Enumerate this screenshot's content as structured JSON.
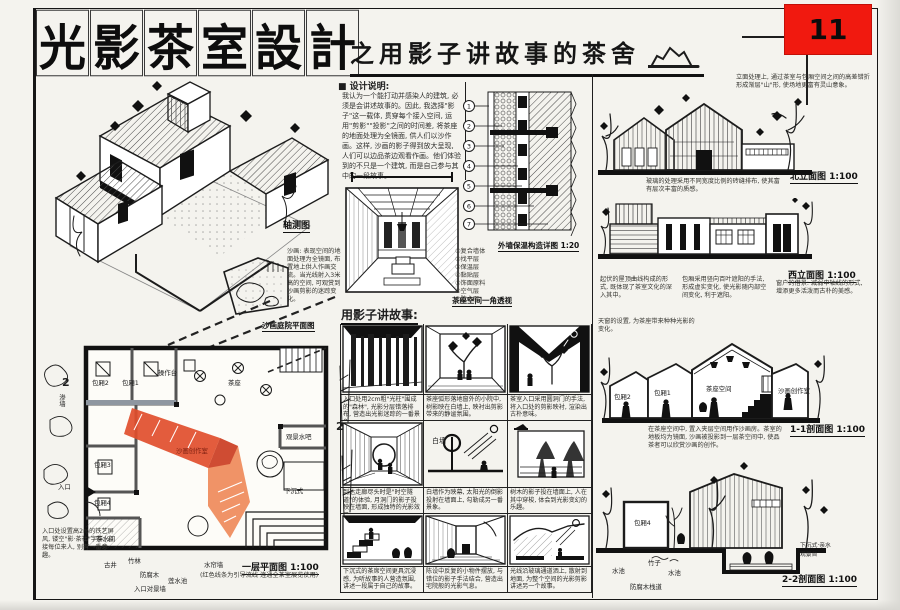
{
  "page": {
    "number": "11",
    "title_chars": [
      "光",
      "影",
      "茶",
      "室",
      "設",
      "計"
    ],
    "subtitle": "之用影子讲故事的茶舍"
  },
  "design_notes": {
    "header": "■ 设计说明:",
    "body": "我认为一个能打动并感染人的建筑, 必须是会讲述故事的。因此, 我选择\"影子\"这一载体, 贯穿每个接入空间, 运用\"剪影\"\"投影\"之间的时间差, 将茶座的地面处理为全镜面, 供人们以沙作画。这样, 沙画的影子得到放大呈现, 人们可以边品茶边观看作画。他们体验到的不只是一个建筑, 而是自己参与其中的一段故事。"
  },
  "axon": {
    "label": "轴测图",
    "note": "沙画: 表现空间的地面处理为全镜面, 布置地上供人作画交流。当光线射入3米高的空间, 可观赏到沙画剪影的迷踪变化。",
    "partial_plan_caption": "沙画庭院平面图"
  },
  "perspective": {
    "caption": "茶座空间一角透视"
  },
  "wall_detail": {
    "caption": "外墙保温构造详图 1:20",
    "callouts": [
      "1",
      "2",
      "3",
      "4",
      "5",
      "6",
      "7"
    ],
    "legend": [
      "①复合墙体",
      "②找平层",
      "③保温层",
      "④黏贴层",
      "⑤饰面原料",
      "⑥空气层",
      "⑦防水层"
    ]
  },
  "storyboard": {
    "header": "用影子讲故事:",
    "wall_label": "白墙",
    "captions": [
      "入口处用2cm粗\"光柱\"围成的\"森林\", 光影分层错落排布, 营造出光影迷踪的一番景象。",
      "茶座弧形落地窗外的小院中, 树影映在白墙上, 映衬出剪影带来的静谧氛围。",
      "茶室入口采用圆洞门的手法, 将入口处的剪影映衬, 渲染出古朴意味。",
      "到达走廊尽头时是\"时空隧道\"的体验, 月洞门的影子投映在墙面, 形成独特的光影效果。",
      "白墙作为映幕, 太阳光的倒影投射在墙面上, 勾勒成另一番景象。",
      "树木的影子投在墙面上, 人在其中穿梭, 体会到光影变幻的乐趣。",
      "下沉式的茶席空间更具沉浸感, 为听故事的人营造氛围, 讲述一段属于自己的故事。",
      "陈设中反复的小物件摆放, 与错位的影子手法结合, 营造出宅院般的光影气息。",
      "光线沿玻璃通道洒上, 散射到地面, 为整个空间的光影剪影讲述另一个故事。"
    ]
  },
  "elevations": {
    "north": {
      "caption": "北立面图 1:100",
      "note_top": "立面处理上, 通过茶室与包厢空间之间的高差错折形成渐层\"山\"形, 使场地更富有灵山意象。",
      "note_bottom": "玻璃的处理采用不同宽度比例的砖缝排布, 使其富有层次丰富的质感。"
    },
    "west": {
      "caption": "西立面图 1:100",
      "notes": [
        "起伏的屋顶曲线构成的形式, 既体现了茶室文化的深入其中。",
        "包厢采用竖向百叶遮阳的手法, 形成虚实变化, 使光影随内部空间变化, 利于遮阳。",
        "窗户的借景: 减弱中轴线的形式, 增添更多活泼而古朴的美感。"
      ]
    }
  },
  "sections": {
    "s11": {
      "caption": "1-1剖面图 1:100",
      "note_top": "天窗的设置, 为茶座带来种种光影的变化。",
      "note_bottom": "在茶座空间中, 置入夹层空间用作沙画房。茶室的地板均为镜面, 沙画被投影到一层茶空间中, 使品茶者可以欣赏沙画的创作。",
      "rooms": [
        "包厢2",
        "包厢1",
        "茶座空间",
        "沙画创作室"
      ]
    },
    "s22": {
      "caption": "2-2剖面图 1:100",
      "labels": [
        "包厢4",
        "水池",
        "竹子",
        "水池",
        "防腐木栈道",
        "下沉式·亲水观景台"
      ]
    }
  },
  "plan": {
    "caption": "一层平面图 1:100",
    "caption_note": "(红色线条为引导流线 连通全茶室展览使用)",
    "entry_note": "入口处设置高2m的铁艺屏风, 镂空\"影·茶社\"字样, 迎接每位来人, 别有一番意趣。",
    "rooms": [
      "包厢2",
      "包厢1",
      "操作台",
      "茶座",
      "包厢3",
      "包厢4",
      "茶水间",
      "观景水吧",
      "下沉式",
      "沙画创作室"
    ],
    "outer_labels": [
      "渗墙",
      "入口",
      "古井",
      "竹林",
      "防腐木",
      "莲水池",
      "水帘墙",
      "入口对景墙"
    ],
    "section_marker": "2"
  },
  "colors": {
    "badge_red": "#f1190f",
    "plan_red": "#e14e2c",
    "plan_orange": "#ee8757",
    "ink": "#1c1c1c"
  }
}
